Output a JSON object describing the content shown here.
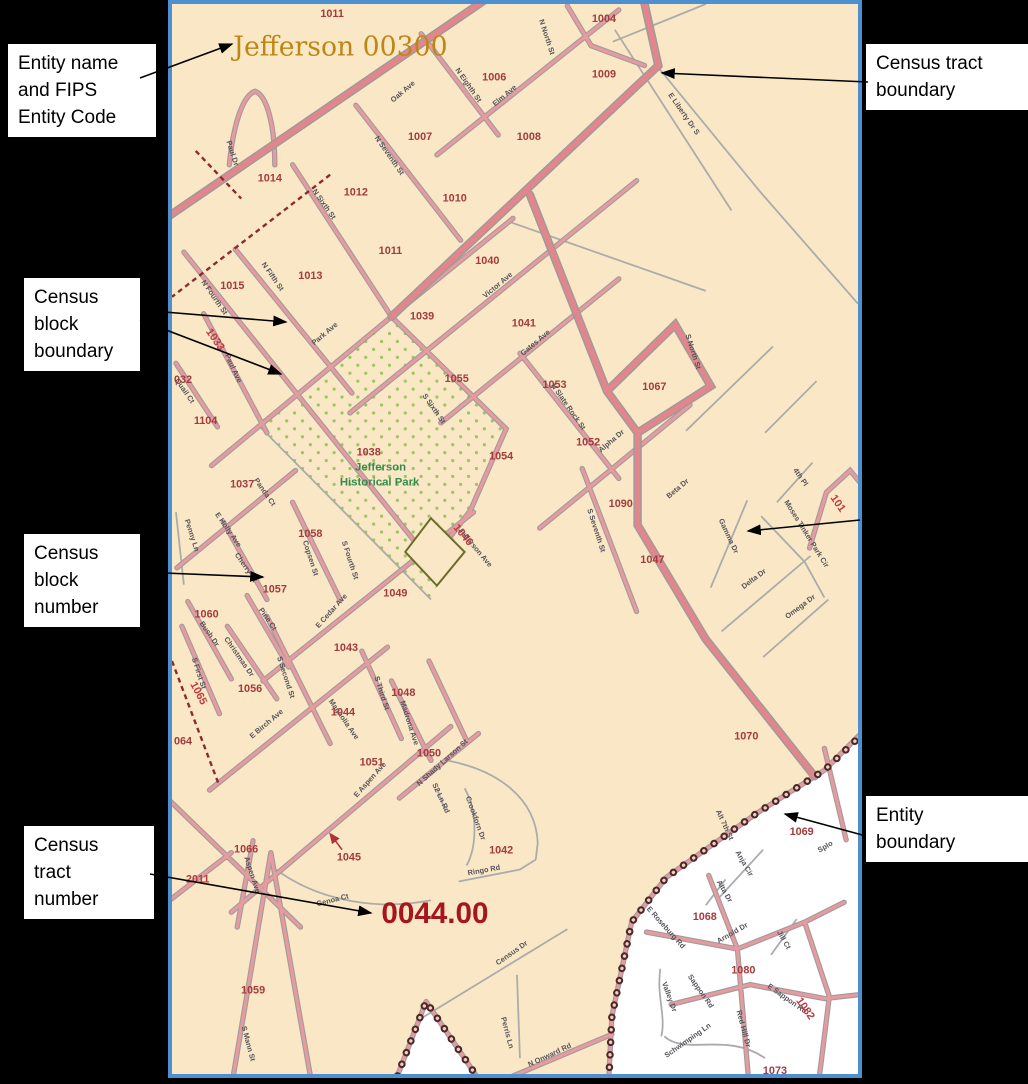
{
  "callouts": {
    "entity_name_lines": [
      "Entity name",
      "and FIPS",
      "Entity Code"
    ],
    "block_boundary_lines": [
      "Census",
      "block",
      "boundary"
    ],
    "block_number_lines": [
      "Census",
      "block",
      "number"
    ],
    "tract_number_lines": [
      "Census",
      "tract",
      "number"
    ],
    "tract_boundary_lines": [
      "Census tract",
      "boundary"
    ],
    "entity_boundary_lines": [
      "Entity",
      "boundary"
    ]
  },
  "map": {
    "title": "Jefferson 00300",
    "tract_number": "0044.00",
    "park": {
      "name_line1": "Jefferson",
      "name_line2": "Historical Park"
    },
    "blocks": [
      "1011",
      "1004",
      "1006",
      "1009",
      "1007",
      "1008",
      "1014",
      "1012",
      "1010",
      "1011",
      "1040",
      "1013",
      "1015",
      "1039",
      "1041",
      "1055",
      "1053",
      "1067",
      "1104",
      "1052",
      "1054",
      "1090",
      "1037",
      "1058",
      "1047",
      "1057",
      "1049",
      "1060",
      "1043",
      "1056",
      "1048",
      "1044",
      "1050",
      "1051",
      "1070",
      "1066",
      "1045",
      "1042",
      "1069",
      "1068",
      "1059",
      "1080",
      "1073",
      "032",
      "064",
      "2011",
      "1038"
    ],
    "red_labels": [
      "1033",
      "1065",
      "1046",
      "101",
      "1082"
    ],
    "streets": [
      "Oak Ave",
      "N North St",
      "Elm Ave",
      "N Eighth St",
      "E Liberty Dr S",
      "N Seventh St",
      "Paul Dr",
      "N Sixth St",
      "Victor Ave",
      "N Fifth St",
      "N Fourth St",
      "Park Ave",
      "Paul Ave",
      "Quail Ct",
      "Gates Ave",
      "S Sixth St",
      "N Slate Rock St",
      "S North St",
      "Alpha Dr",
      "Beta Dr",
      "S Seventh St",
      "4th Pl",
      "Moses Tinker Park Cir",
      "Gamma Dr",
      "Delta Dr",
      "Omega Dr",
      "Penny Ln",
      "E Holly Ave",
      "Panda Ct",
      "Cherry Ct",
      "Copsen St",
      "S Fourth St",
      "Jefferson Ave",
      "E Cedar Ave",
      "Bush Dr",
      "Pine Ct",
      "Christmas Dr",
      "S First St",
      "S Second St",
      "E Birch Ave",
      "Magnolia Ave",
      "S Third St",
      "Madrona Ave",
      "E Aspen Ave",
      "N Shady Larson St",
      "S2 Ln Rd",
      "Crookforn Dr",
      "Ringo Rd",
      "Aspen Ave",
      "Genoa Ct",
      "Census Dr",
      "Perris Ln",
      "N Onward Rd",
      "S Mann St",
      "Alt 7th St",
      "Anja Cir",
      "Alta Dr",
      "Arnold Dr",
      "Jill Ct",
      "Splo",
      "E Roseburg Rd",
      "Sappon Rd",
      "Valley Dr",
      "Schwimping Ln",
      "Red Hill Dr",
      "E Sappon Rd"
    ],
    "colors": {
      "map_background": "#FAE7C5",
      "road_pink": "#E69B9E",
      "road_main_pink": "#E2868B",
      "road_casing_gray": "#A39A9D",
      "minor_road_gray": "#ABABAB",
      "block_number_red": "#A33B3F",
      "rotated_label_red": "#C03A40",
      "title_gold": "#BD8714",
      "park_green": "#338A4E",
      "tract_number_red": "#A5161E",
      "entity_boundary_dot": "#4E262C",
      "map_border_blue": "#4C90D0",
      "outside_entity_white": "#FFFFFF"
    }
  }
}
